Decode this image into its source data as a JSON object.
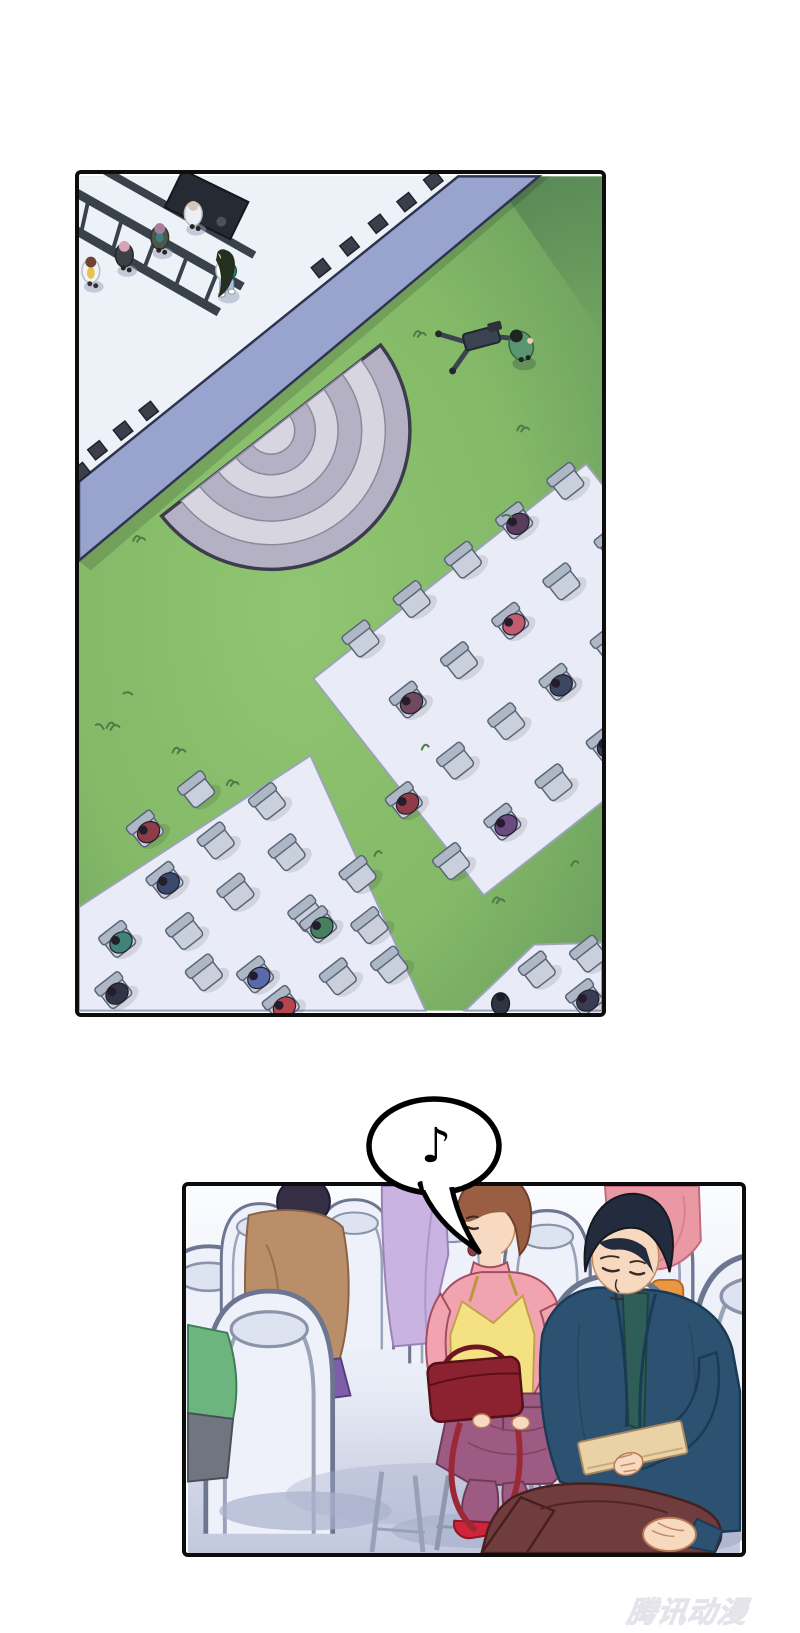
{
  "page": {
    "width": 800,
    "height": 1633,
    "background": "#ffffff"
  },
  "watermark": {
    "text": "腾讯动漫",
    "color": "#ececf0"
  },
  "speech_bubble": {
    "note": "♪",
    "fill": "#ffffff",
    "stroke": "#000000"
  },
  "panel_aerial": {
    "description": "Overhead view of an outdoor event: a stage with lighting truss, staff and a performer, a striped half-dome canopy, a lawn with a camera rig and operator, and diagonal blocks of folding chairs with a sparse audience.",
    "palette": {
      "grass": "#86bb68",
      "grass_shadow": "#54815b",
      "stage_floor": "#edf1f8",
      "stage_edge": "#98a4ce",
      "dome_dark": "#b3b1c3",
      "dome_light": "#d7d6e0",
      "mat": "#e9ecf6",
      "chair": "#c9d0dc",
      "speaker": "#3a3f4b"
    },
    "right_chairs": [
      [
        289,
        472,
        null
      ],
      [
        341,
        432,
        null
      ],
      [
        393,
        392,
        null
      ],
      [
        445,
        352,
        "#5a3c5e"
      ],
      [
        497,
        312,
        null
      ],
      [
        337,
        534,
        "#6f4a5e"
      ],
      [
        389,
        494,
        null
      ],
      [
        441,
        454,
        "#c25b70"
      ],
      [
        493,
        414,
        null
      ],
      [
        545,
        374,
        null
      ],
      [
        385,
        596,
        null
      ],
      [
        437,
        556,
        null
      ],
      [
        489,
        516,
        "#3d4663"
      ],
      [
        541,
        476,
        null
      ],
      [
        333,
        636,
        "#8e3d46"
      ],
      [
        433,
        658,
        "#6b4a80"
      ],
      [
        485,
        618,
        null
      ],
      [
        537,
        578,
        "#3a3f58"
      ],
      [
        381,
        698,
        null
      ]
    ],
    "left_chairs": [
      [
        70,
        665,
        "#8e3d46"
      ],
      [
        122,
        625,
        null
      ],
      [
        90,
        717,
        "#39486b"
      ],
      [
        142,
        677,
        null
      ],
      [
        194,
        637,
        null
      ],
      [
        42,
        777,
        "#3f8577"
      ],
      [
        110,
        769,
        null
      ],
      [
        162,
        729,
        null
      ],
      [
        214,
        689,
        null
      ],
      [
        38,
        829,
        "#2f3547"
      ],
      [
        130,
        811,
        null
      ],
      [
        182,
        813,
        "#5a6aa8"
      ],
      [
        234,
        751,
        null
      ],
      [
        286,
        711,
        null
      ],
      [
        208,
        843,
        "#b5444c"
      ],
      [
        246,
        762,
        "#47805e"
      ],
      [
        298,
        763,
        null
      ],
      [
        266,
        815,
        null
      ],
      [
        318,
        803,
        null
      ]
    ],
    "corner_chairs": [
      [
        468,
        808,
        null
      ],
      [
        520,
        792,
        null
      ],
      [
        516,
        836,
        "#383d52"
      ]
    ]
  },
  "panel_closeup": {
    "description": "Close view of the audience rows: a woman in a pink top, yellow camisole and plum trousers holds a dark-red handbag beside white banquet chairs, while a man in a navy suit sits cross-legged studying a beige card as a musical note sounds.",
    "palette": {
      "chair": "#eef1f9",
      "chair_line": "#6d7690",
      "floor": "#c7cde1",
      "pink_top": "#f2a3b0",
      "camisole": "#f4e282",
      "trousers": "#9d5a82",
      "handbag": "#8c2230",
      "heels": "#cf2439",
      "suit": "#2d5170",
      "shirt": "#2f5d57",
      "slacks": "#703c3d",
      "card": "#e8d2a6",
      "skin": "#f7d9c0"
    }
  }
}
